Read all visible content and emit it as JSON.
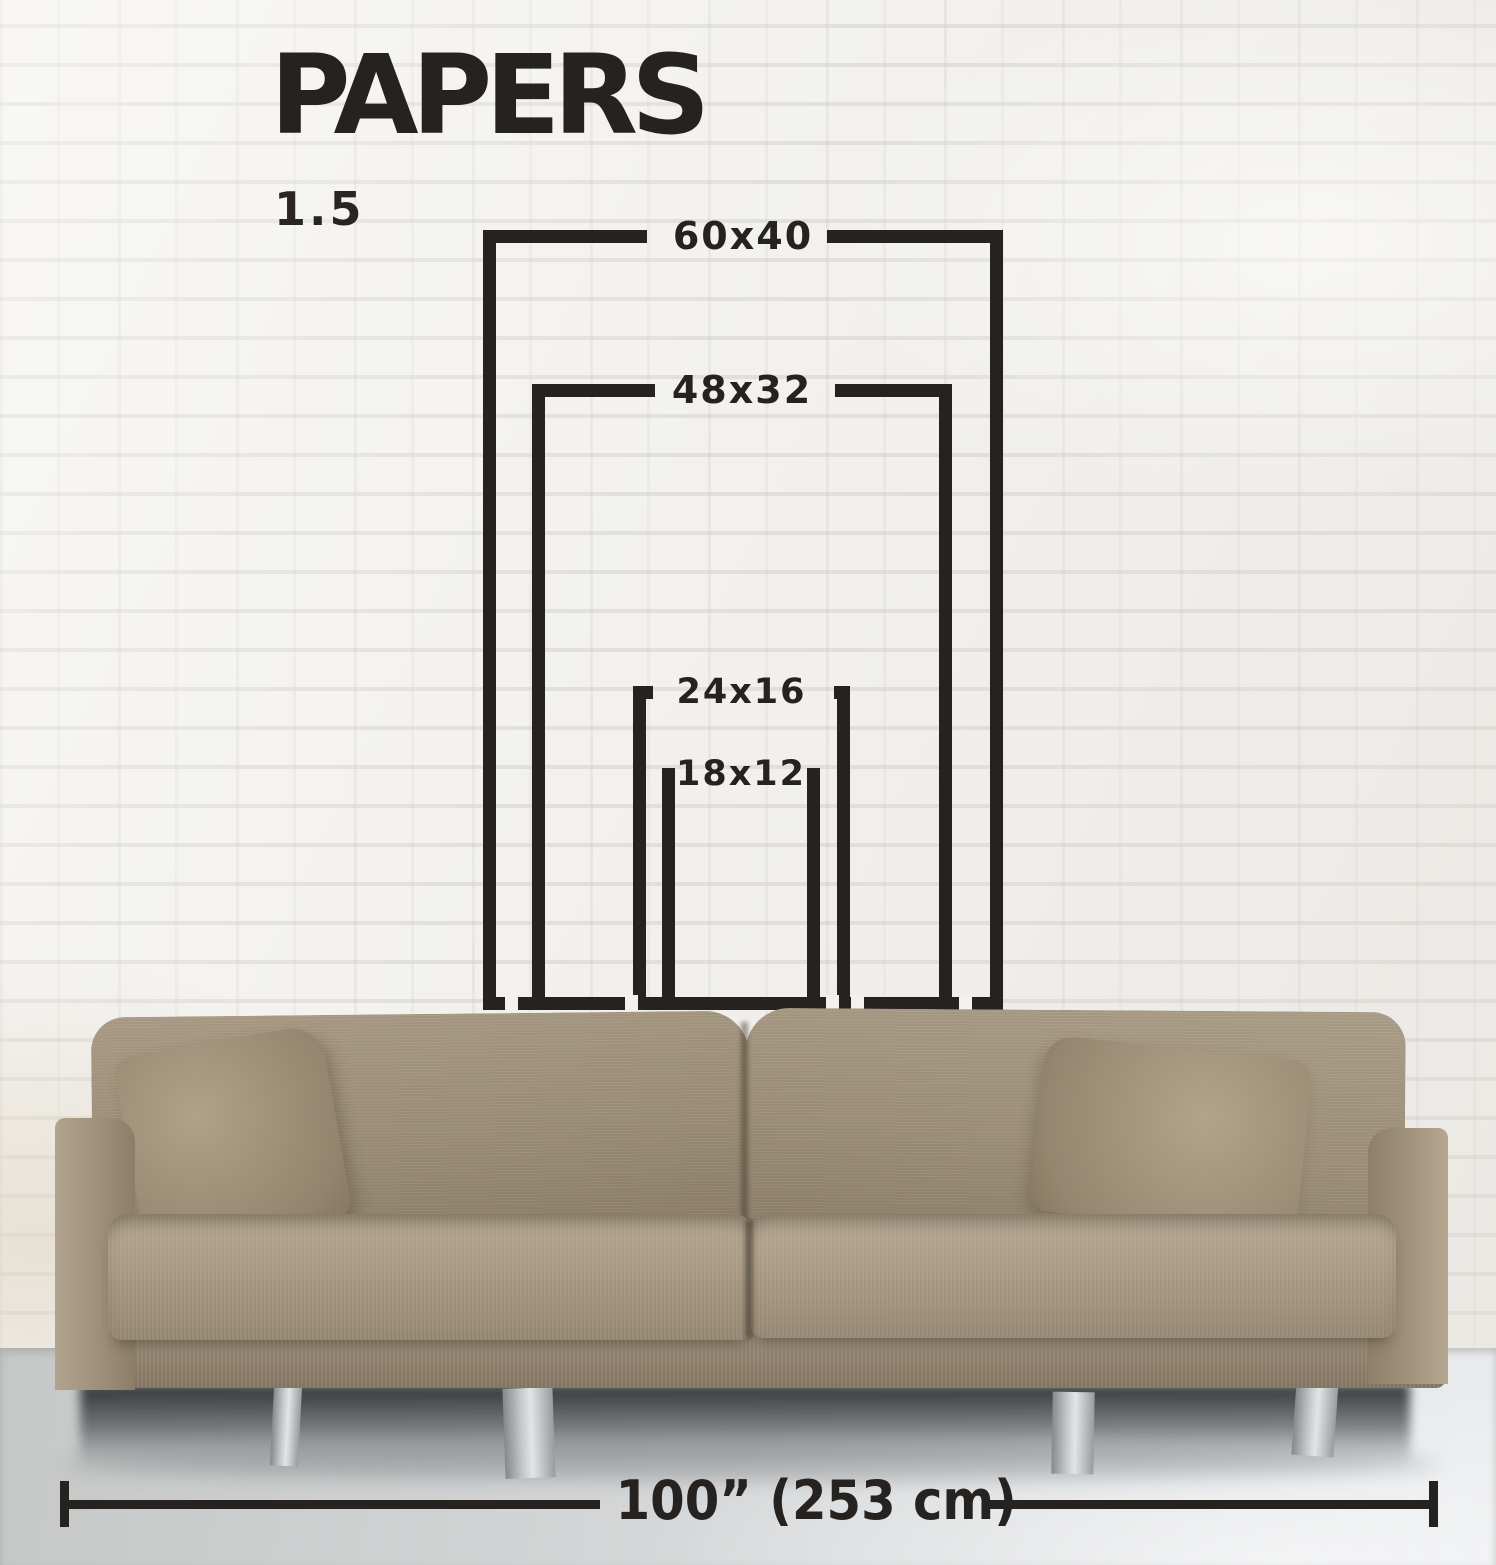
{
  "title": "PAPERS",
  "ratio_label": "1.5",
  "size_outlines": [
    {
      "label": "60x40"
    },
    {
      "label": "48x32"
    },
    {
      "label": "24x16"
    },
    {
      "label": "18x12"
    }
  ],
  "sofa_width_label": "100” (253 cm)",
  "colors": {
    "ink": "#262220",
    "wall": "#f2f1ee",
    "floor": "#d9dbdd",
    "sofa_fabric": "#a4957e"
  }
}
